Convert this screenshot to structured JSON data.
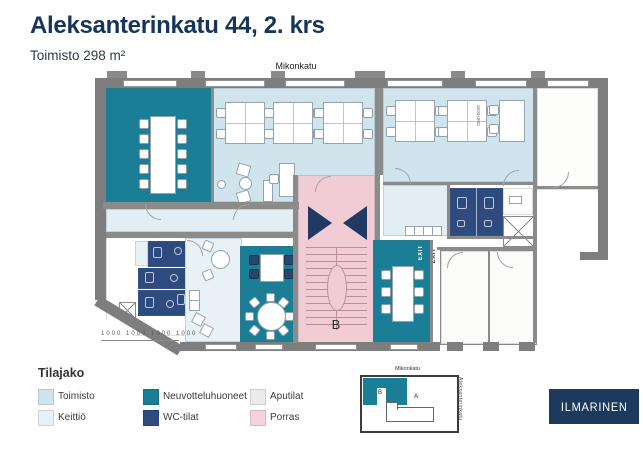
{
  "header": {
    "title": "Aleksanterinkatu 44, 2. krs",
    "subtitle": "Toimisto 298 m²",
    "street_label": "Mikonkatu"
  },
  "plan": {
    "stairwell_label": "B",
    "exit_label": "EXIT",
    "exit_label_2": "EXIT",
    "desk_size_label": "1600x800",
    "dimension_labels": "1000 1000 1000 1000"
  },
  "legend": {
    "title": "Tilajako",
    "items": [
      {
        "label": "Toimisto",
        "color": "#cfe4ec"
      },
      {
        "label": "Keittiö",
        "color": "#e7f1f6"
      },
      {
        "label": "Neuvotteluhuoneet",
        "color": "#1a7e96"
      },
      {
        "label": "WC-tilat",
        "color": "#2d4b7e"
      },
      {
        "label": "Aputilat",
        "color": "#ebebe9"
      },
      {
        "label": "Porras",
        "color": "#f6d3da"
      }
    ]
  },
  "minimap": {
    "street_top": "Mikonkatu",
    "street_right": "Aleksanterinkatu",
    "section_a_label": "A",
    "section_b_label": "B"
  },
  "logo_text": "ILMARINEN",
  "colors": {
    "title_navy": "#17345d",
    "office_blue": "#cfe4ec",
    "kitchen_pale": "#e7f1f6",
    "meeting_teal": "#1a7e96",
    "wc_navy": "#2d4b7e",
    "stairs_pink": "#f2ccd4",
    "aux_gray": "#ebebe9",
    "wall_gray": "#7e7e7e",
    "logo_navy": "#1c3a5e"
  }
}
